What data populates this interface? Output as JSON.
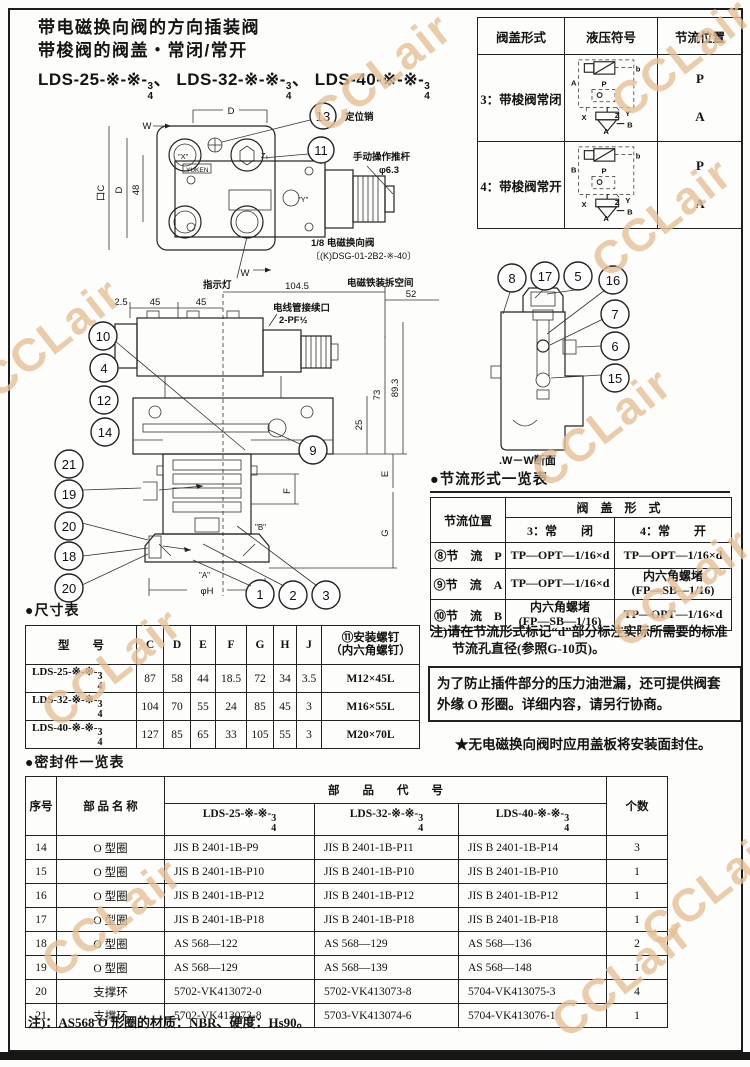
{
  "header": {
    "title1": "带电磁换向阀的方向插装阀",
    "title2": "带梭阀的阀盖・常闭/常开",
    "models": [
      {
        "prefix": "LDS-25-※-※-",
        "num": "3",
        "den": "4",
        "sep": "、"
      },
      {
        "prefix": "LDS-32-※-※-",
        "num": "3",
        "den": "4",
        "sep": "、"
      },
      {
        "prefix": "LDS-40-※-※-",
        "num": "3",
        "den": "4",
        "sep": ""
      }
    ]
  },
  "cover_table": {
    "h_form": "阀盖形式",
    "h_symbol": "液压符号",
    "h_pos": "节流位置",
    "rows": [
      {
        "form": "3：带梭阀常闭",
        "p1": "P",
        "p2": "A",
        "sym": {
          "top_left": "A",
          "b": "b",
          "P": "P",
          "X": "X",
          "Z": "Z",
          "Y": "Y",
          "B": "B",
          "A": "A"
        }
      },
      {
        "form": "4：带梭阀常开",
        "p1": "P",
        "p2": "A",
        "sym": {
          "top_left": "B",
          "b": "b",
          "P": "P",
          "X": "X",
          "Z": "Z",
          "Y": "Y",
          "B": "B",
          "A": "A"
        }
      }
    ]
  },
  "top_view": {
    "callout_13": "13",
    "callout_11": "11",
    "locating_pin": "定位销",
    "manual_rod": "手动操作推杆",
    "manual_rod_dia": "φ6.3",
    "indicator": "指示灯",
    "solenoid_line1": "1/8 电磁换向阀",
    "solenoid_line2": "〔(K)DSG-01-2B2-※-40〕",
    "brand": "YUKEN",
    "dim_d_top": "D",
    "w_top": "W",
    "w_bottom": "W",
    "dim_c": "口C",
    "dim_d_left": "D",
    "dim_48": "48",
    "label_x": "\"X\"",
    "label_y": "\"Y\"",
    "label_z1": "Z₁"
  },
  "section_view": {
    "removal_space": "电磁铁装拆空间",
    "dim_52": "52",
    "dim_104_5": "104.5",
    "dim_2_5": "2.5",
    "dim_45a": "45",
    "dim_45b": "45",
    "conduit_line1": "电线管接续口",
    "conduit_line2": "2-PF½",
    "dim_73": "73",
    "dim_89_3": "89.3",
    "dim_25": "25",
    "dim_E": "E",
    "dim_F": "F",
    "dim_G": "G",
    "dim_phiH": "φH",
    "label_a": "\"A\"",
    "label_b": "\"B\"",
    "callouts": {
      "c10": "10",
      "c4": "4",
      "c12": "12",
      "c14": "14",
      "c21": "21",
      "c19": "19",
      "c20a": "20",
      "c18": "18",
      "c20b": "20",
      "c1": "1",
      "c2": "2",
      "c3": "3",
      "c9": "9"
    }
  },
  "ww": {
    "caption": ".W－W断面",
    "c8": "8",
    "c17": "17",
    "c5": "5",
    "c16": "16",
    "c7": "7",
    "c6": "6",
    "c15": "15"
  },
  "throttle": {
    "title": "●节流形式一览表",
    "h_pos": "节流位置",
    "h_cover": "阀　盖　形　式",
    "sub_closed": "3：常　　闭",
    "sub_open": "4：常　　开",
    "rows": [
      {
        "pos": "⑧节　流　P",
        "c1l1": "TP—OPT—1/16×d",
        "c2l1": "TP—OPT—1/16×d"
      },
      {
        "pos": "⑨节　流　A",
        "c1l1": "TP—OPT—1/16×d",
        "c2l1": "内六角螺堵",
        "c2l2": "(FP—SB—1/16)"
      },
      {
        "pos": "⑩节　流　B",
        "c1l1": "内六角螺堵",
        "c1l2": "(FP—SB—1/16)",
        "c2l1": "TP—OPT—1/16×d"
      }
    ],
    "note1": "注)请在节流形式标记“d”部分标注实际所需要的标准",
    "note2": "节流孔直径(参照G-10页)。"
  },
  "notes": {
    "box1": "为了防止插件部分的压力油泄漏，还可提供阀套",
    "box2": "外缘 O 形圈。详细内容，请另行协商。",
    "star": "★无电磁换向阀时应用盖板将安装面封住。",
    "seal_note": "注)：AS568 O 形圈的材质：NBR、硬度：Hs90。"
  },
  "dim_table": {
    "title": "●尺寸表",
    "h_model": "型　　号",
    "h_c": "C",
    "h_d": "D",
    "h_e": "E",
    "h_f": "F",
    "h_g": "G",
    "h_h": "H",
    "h_j": "J",
    "h_screw1": "⑪安装螺钉",
    "h_screw2": "（内六角螺钉）",
    "rows": [
      {
        "model": "LDS-25-※-※-",
        "num": "3",
        "den": "4",
        "c": "87",
        "d": "58",
        "e": "44",
        "f": "18.5",
        "g": "72",
        "h": "34",
        "j": "3.5",
        "screw": "M12×45L"
      },
      {
        "model": "LDS-32-※-※-",
        "num": "3",
        "den": "4",
        "c": "104",
        "d": "70",
        "e": "55",
        "f": "24",
        "g": "85",
        "h": "45",
        "j": "3",
        "screw": "M16×55L"
      },
      {
        "model": "LDS-40-※-※-",
        "num": "3",
        "den": "4",
        "c": "127",
        "d": "85",
        "e": "65",
        "f": "33",
        "g": "105",
        "h": "55",
        "j": "3",
        "screw": "M20×70L"
      }
    ]
  },
  "seal_table": {
    "title": "●密封件一览表",
    "h_no": "序号",
    "h_name": "部 品 名 称",
    "h_code": "部　　品　　代　　号",
    "h_qty": "个数",
    "models": [
      {
        "prefix": "LDS-25-※-※-",
        "num": "3",
        "den": "4"
      },
      {
        "prefix": "LDS-32-※-※-",
        "num": "3",
        "den": "4"
      },
      {
        "prefix": "LDS-40-※-※-",
        "num": "3",
        "den": "4"
      }
    ],
    "rows": [
      {
        "no": "14",
        "name": "O 型圈",
        "c25": "JIS B 2401-1B-P9",
        "c32": "JIS B 2401-1B-P11",
        "c40": "JIS B 2401-1B-P14",
        "qty": "3"
      },
      {
        "no": "15",
        "name": "O 型圈",
        "c25": "JIS B 2401-1B-P10",
        "c32": "JIS B 2401-1B-P10",
        "c40": "JIS B 2401-1B-P10",
        "qty": "1"
      },
      {
        "no": "16",
        "name": "O 型圈",
        "c25": "JIS B 2401-1B-P12",
        "c32": "JIS B 2401-1B-P12",
        "c40": "JIS B 2401-1B-P12",
        "qty": "1"
      },
      {
        "no": "17",
        "name": "O 型圈",
        "c25": "JIS B 2401-1B-P18",
        "c32": "JIS B 2401-1B-P18",
        "c40": "JIS B 2401-1B-P18",
        "qty": "1"
      },
      {
        "no": "18",
        "name": "O 型圈",
        "c25": "AS 568—122",
        "c32": "AS 568—129",
        "c40": "AS 568—136",
        "qty": "2"
      },
      {
        "no": "19",
        "name": "O 型圈",
        "c25": "AS 568—129",
        "c32": "AS 568—139",
        "c40": "AS 568—148",
        "qty": "1"
      },
      {
        "no": "20",
        "name": "支撑环",
        "c25": "5702-VK413072-0",
        "c32": "5702-VK413073-8",
        "c40": "5704-VK413075-3",
        "qty": "4"
      },
      {
        "no": "21",
        "name": "支撑环",
        "c25": "5702-VK413073-8",
        "c32": "5703-VK413074-6",
        "c40": "5704-VK413076-1",
        "qty": "1"
      }
    ]
  },
  "watermark": {
    "text": "CCLair",
    "color": "#e7c096"
  }
}
